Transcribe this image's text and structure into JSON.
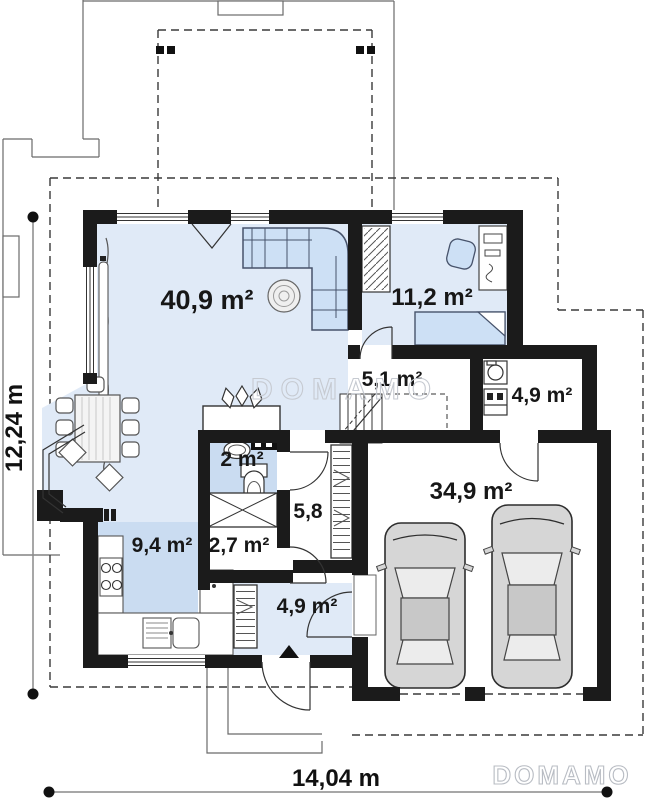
{
  "plan": {
    "rooms": [
      {
        "name": "living-room",
        "area": "40,9 m²"
      },
      {
        "name": "office",
        "area": "11,2 m²"
      },
      {
        "name": "stair-hall",
        "area": "5,1 m²"
      },
      {
        "name": "utility-room",
        "area": "4,9 m²"
      },
      {
        "name": "wc",
        "area": "2 m²"
      },
      {
        "name": "corridor",
        "area": "5,8"
      },
      {
        "name": "pantry",
        "area": "2,7 m²"
      },
      {
        "name": "kitchen",
        "area": "9,4 m²"
      },
      {
        "name": "entry-hall",
        "area": "4,9 m²"
      },
      {
        "name": "garage",
        "area": "34,9 m²"
      }
    ],
    "dimensions": {
      "total_width": "14,04 m",
      "total_height": "12,24 m"
    },
    "watermarks": {
      "center": "DOMAMO",
      "bottom_right": "DOMAMO"
    },
    "colors": {
      "wall": "#1b1b1b",
      "floor_light": "#e0eaf7",
      "floor_accent": "#cadcf1",
      "furniture_outline": "#47536b",
      "car_body": "#d6d6d6"
    }
  }
}
